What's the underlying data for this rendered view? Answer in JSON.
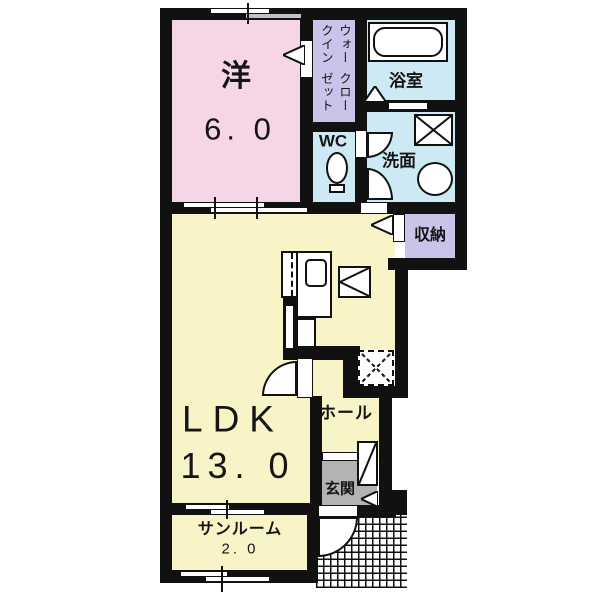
{
  "colors": {
    "wall": "#111111",
    "bedroom_pink": "#f6d6e6",
    "closet_lavender": "#c9c5ea",
    "wet_area_blue": "#cdeaf4",
    "living_yellow": "#f9f3c8",
    "entrance_gray": "#b3b3b3"
  },
  "rooms": {
    "bedroom": {
      "label": "洋",
      "size": "6. 0"
    },
    "walk_in_closet": {
      "line1": "ウォークイン",
      "line2": "クローゼット"
    },
    "bathroom": {
      "label": "浴室"
    },
    "toilet": {
      "label": "WC"
    },
    "washroom": {
      "label": "洗面"
    },
    "storage": {
      "label": "収納"
    },
    "ldk": {
      "label": "LDK",
      "size": "13. 0"
    },
    "hall": {
      "label": "ホール"
    },
    "entrance": {
      "label": "玄関"
    },
    "sunroom": {
      "label": "サンルーム",
      "size": "2. 0"
    }
  }
}
